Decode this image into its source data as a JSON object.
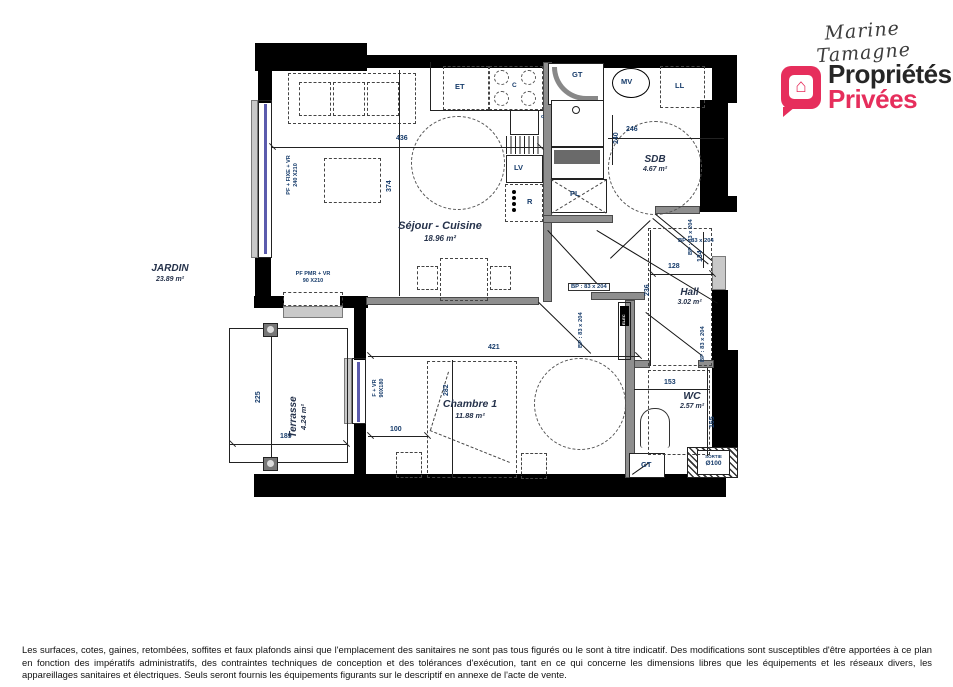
{
  "branding": {
    "signature": "Marine Tamagne",
    "logo": {
      "line1": "Propriétés",
      "line2": "Privées",
      "accent_color": "#e62e5c",
      "text_color": "#262626",
      "icon": "house-speech-bubble"
    }
  },
  "rooms": {
    "sejour": {
      "name": "Séjour - Cuisine",
      "area": "18.96 m²"
    },
    "chambre": {
      "name": "Chambre 1",
      "area": "11.88 m²"
    },
    "sdb": {
      "name": "SDB",
      "area": "4.67 m²"
    },
    "hall": {
      "name": "Hall",
      "area": "3.02 m²"
    },
    "wc": {
      "name": "WC",
      "area": "2.57 m²"
    },
    "terrasse": {
      "name": "Terrasse",
      "area": "4.24 m²"
    },
    "jardin": {
      "name": "JARDIN",
      "area": "23.89 m²"
    }
  },
  "fixtures": {
    "et": "ET",
    "cooktop": "C",
    "oven": "c",
    "lv": "LV",
    "fridge": "R",
    "gt_kitchen": "GT",
    "mv": "MV",
    "ll": "LL",
    "pl": "PL",
    "gt_wc": "GT",
    "elec": "ELEC",
    "sortie": "SORTIE",
    "sortie_diam": "Ø100"
  },
  "doors": {
    "bp": "BP : 83 x 204"
  },
  "windows": {
    "sejour_type": "PF + FIXE + VR",
    "sejour_size": "240 X210",
    "terrasse_type": "PF PMR + VR",
    "terrasse_size": "90 X210",
    "chambre_type": "F + VR",
    "chambre_size": "90X180"
  },
  "dims": {
    "sejour_w": "436",
    "sejour_h": "374",
    "sdb_w": "246",
    "sdb_h": "240",
    "hall_w": "128",
    "hall_h": "236",
    "entry": "134",
    "chambre_w": "421",
    "chambre_h": "282",
    "chambre_off": "100",
    "wc_w": "153",
    "wc_h": "165",
    "terrasse_h": "225",
    "terrasse_w": "189"
  },
  "footer": {
    "disclaimer": "Les surfaces, cotes, gaines, retombées, soffites et faux plafonds ainsi que l'emplacement des sanitaires ne sont pas tous figurés ou le sont à titre indicatif. Des modifications sont susceptibles d'être apportées à ce plan en fonction des impératifs administratifs, des contraintes techniques de conception et des tolérances d'exécution, tant en ce qui concerne les dimensions libres que les équipements et les réseaux divers, les appareillages sanitaires et électriques. Seuls seront fournis les équipements figurants sur le descriptif en annexe de l'acte de vente."
  }
}
